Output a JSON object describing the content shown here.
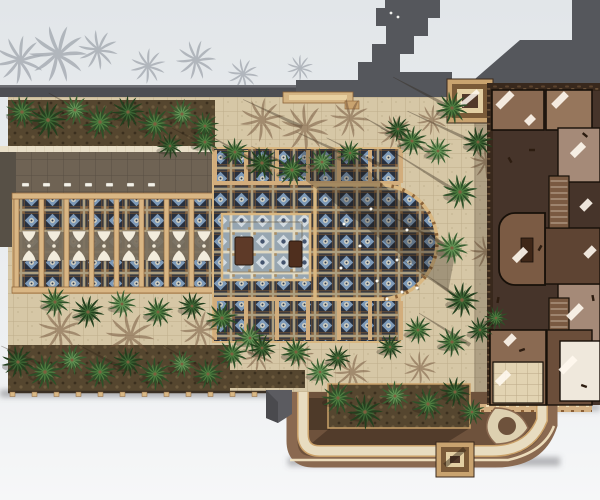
{
  "scene": {
    "description": "Top-down architectural rendering of a palace complex: ornate blue-tiled basilica courtyard with semicircular apse, wooden colonnade, palm-planted plazas, charcoal roof structures and a cut-away brown building floor plan on the right.",
    "palette": {
      "background": "#e4e8eb",
      "roof_charcoal": "#55575c",
      "pavement_tan": "#d6c7a6",
      "walkway_cream": "#e9dfc8",
      "wood_tan": "#d9b684",
      "tile_navy": "#28303e",
      "tile_blue": "#7e9ab8",
      "palm_green": "#4f7f41",
      "building_dark": "#46342a",
      "room_brown": "#8a6a52",
      "road_brown": "#6e523c",
      "sunlit_edge": "#f6e9c6"
    },
    "palms": [
      [
        22,
        112,
        15,
        0,
        "m"
      ],
      [
        48,
        120,
        17,
        40,
        "d"
      ],
      [
        75,
        110,
        14,
        200,
        "l"
      ],
      [
        100,
        122,
        16,
        90,
        "m"
      ],
      [
        128,
        112,
        15,
        160,
        "d"
      ],
      [
        155,
        124,
        16,
        20,
        "m"
      ],
      [
        182,
        114,
        14,
        230,
        "l"
      ],
      [
        205,
        126,
        13,
        300,
        "m"
      ],
      [
        170,
        146,
        12,
        70,
        "d"
      ],
      [
        235,
        152,
        13,
        10,
        "m"
      ],
      [
        262,
        163,
        15,
        120,
        "d"
      ],
      [
        292,
        170,
        15,
        200,
        "m"
      ],
      [
        322,
        162,
        13,
        60,
        "l"
      ],
      [
        350,
        153,
        12,
        320,
        "m"
      ],
      [
        205,
        142,
        13,
        310,
        "m"
      ],
      [
        398,
        129,
        12,
        20,
        "d"
      ],
      [
        412,
        141,
        14,
        80,
        "m"
      ],
      [
        438,
        151,
        13,
        190,
        "l"
      ],
      [
        55,
        302,
        14,
        45,
        "m"
      ],
      [
        88,
        312,
        15,
        140,
        "d"
      ],
      [
        122,
        304,
        13,
        260,
        "l"
      ],
      [
        158,
        312,
        14,
        0,
        "m"
      ],
      [
        192,
        306,
        13,
        90,
        "d"
      ],
      [
        222,
        318,
        15,
        180,
        "m"
      ],
      [
        250,
        338,
        14,
        270,
        "l"
      ],
      [
        232,
        354,
        14,
        60,
        "m"
      ],
      [
        262,
        348,
        13,
        150,
        "d"
      ],
      [
        296,
        352,
        14,
        240,
        "m"
      ],
      [
        320,
        372,
        13,
        0,
        "l"
      ],
      [
        338,
        358,
        12,
        90,
        "d"
      ],
      [
        18,
        362,
        15,
        30,
        "d"
      ],
      [
        45,
        372,
        16,
        150,
        "m"
      ],
      [
        72,
        360,
        14,
        240,
        "l"
      ],
      [
        100,
        372,
        15,
        60,
        "m"
      ],
      [
        128,
        362,
        14,
        330,
        "d"
      ],
      [
        155,
        374,
        15,
        100,
        "m"
      ],
      [
        182,
        364,
        13,
        210,
        "l"
      ],
      [
        208,
        374,
        14,
        0,
        "m"
      ],
      [
        338,
        398,
        15,
        45,
        "m"
      ],
      [
        365,
        412,
        16,
        160,
        "d"
      ],
      [
        395,
        396,
        14,
        280,
        "l"
      ],
      [
        428,
        404,
        15,
        20,
        "m"
      ],
      [
        455,
        392,
        14,
        140,
        "d"
      ],
      [
        472,
        412,
        12,
        260,
        "m"
      ],
      [
        452,
        108,
        15,
        0,
        "m"
      ],
      [
        478,
        142,
        14,
        90,
        "d"
      ],
      [
        460,
        192,
        16,
        180,
        "m"
      ],
      [
        452,
        248,
        15,
        270,
        "l"
      ],
      [
        462,
        300,
        16,
        45,
        "d"
      ],
      [
        452,
        342,
        14,
        135,
        "m"
      ],
      [
        480,
        330,
        12,
        0,
        "d"
      ],
      [
        496,
        318,
        11,
        200,
        "m"
      ],
      [
        418,
        330,
        13,
        70,
        "m"
      ],
      [
        390,
        347,
        12,
        160,
        "d"
      ]
    ],
    "silhouette_palms": [
      [
        20,
        60,
        22
      ],
      [
        58,
        54,
        26
      ],
      [
        98,
        50,
        18
      ],
      [
        148,
        66,
        16
      ],
      [
        196,
        60,
        18
      ],
      [
        243,
        74,
        14
      ],
      [
        300,
        68,
        12
      ]
    ],
    "frond_shadows": [
      [
        262,
        120,
        20
      ],
      [
        305,
        128,
        22
      ],
      [
        350,
        118,
        18
      ],
      [
        395,
        132,
        16
      ],
      [
        432,
        120,
        14
      ],
      [
        60,
        330,
        20
      ],
      [
        130,
        336,
        22
      ],
      [
        200,
        330,
        18
      ],
      [
        258,
        356,
        15
      ],
      [
        486,
        162,
        15
      ],
      [
        486,
        252,
        15
      ],
      [
        352,
        372,
        17
      ],
      [
        300,
        356,
        13
      ],
      [
        420,
        368,
        15
      ],
      [
        505,
        340,
        13
      ]
    ],
    "shadow_streaks": [
      [
        455,
        110,
        70,
        208
      ],
      [
        480,
        145,
        80,
        205
      ],
      [
        462,
        195,
        85,
        212
      ],
      [
        455,
        250,
        75,
        208
      ],
      [
        465,
        302,
        80,
        214
      ],
      [
        350,
        157,
        60,
        205
      ],
      [
        300,
        172,
        55,
        208
      ],
      [
        252,
        160,
        50,
        210
      ],
      [
        162,
        128,
        55,
        205
      ],
      [
        92,
        118,
        50,
        210
      ],
      [
        42,
        365,
        45,
        205
      ],
      [
        122,
        368,
        50,
        208
      ],
      [
        202,
        368,
        45,
        210
      ],
      [
        340,
        400,
        55,
        35
      ],
      [
        400,
        400,
        60,
        32
      ],
      [
        442,
        408,
        50,
        38
      ],
      [
        302,
        127,
        65,
        205
      ],
      [
        380,
        165,
        60,
        207
      ],
      [
        412,
        145,
        55,
        210
      ],
      [
        470,
        345,
        60,
        212
      ],
      [
        430,
        152,
        55,
        206
      ],
      [
        215,
        150,
        48,
        207
      ]
    ],
    "birds": [
      [
        344,
        224
      ],
      [
        360,
        246
      ],
      [
        341,
        268
      ],
      [
        377,
        281
      ],
      [
        397,
        260
      ],
      [
        407,
        230
      ],
      [
        387,
        299
      ],
      [
        417,
        288
      ],
      [
        371,
        209
      ],
      [
        402,
        292
      ]
    ],
    "bench_row": {
      "x0": 22,
      "y": 183,
      "count": 7,
      "step": 21
    },
    "corbel_row": {
      "x0": 10,
      "y": 392,
      "count": 13,
      "step": 22
    },
    "colonnade": {
      "x0": 14,
      "step": 25,
      "bays": 8,
      "top": 196,
      "bottom": 289
    },
    "arcade_mullions": {
      "x0": 213,
      "step": 31,
      "count": 7
    },
    "light_patches": [
      [
        505,
        100,
        20
      ],
      [
        560,
        100,
        18
      ],
      [
        578,
        150,
        16
      ],
      [
        520,
        255,
        16
      ],
      [
        575,
        312,
        18
      ],
      [
        503,
        378,
        16
      ],
      [
        568,
        365,
        20
      ],
      [
        586,
        205,
        12
      ],
      [
        590,
        252,
        12
      ],
      [
        530,
        120,
        10
      ],
      [
        510,
        340,
        12
      ]
    ],
    "furniture_marks": [
      [
        532,
        150
      ],
      [
        585,
        135
      ],
      [
        593,
        298
      ],
      [
        540,
        248
      ],
      [
        522,
        350
      ],
      [
        584,
        386
      ],
      [
        510,
        160
      ],
      [
        498,
        300
      ]
    ],
    "tower_skylights": [
      [
        391,
        13
      ],
      [
        398,
        17
      ]
    ]
  }
}
